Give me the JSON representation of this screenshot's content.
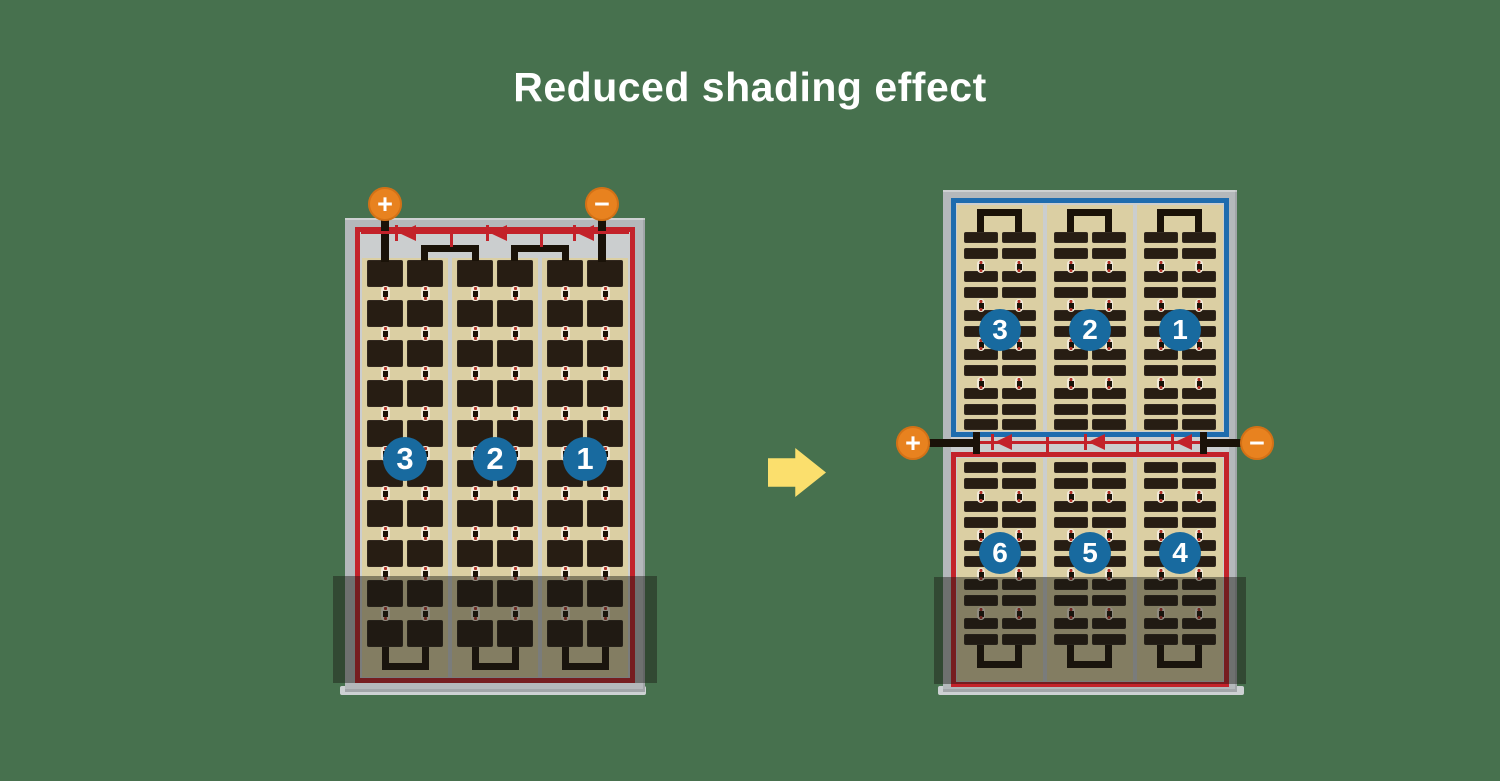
{
  "title": "Reduced shading effect",
  "colors": {
    "bg": "#47714e",
    "title": "#ffffff",
    "frame": "#b4b8bb",
    "silver": "#cbcecf",
    "tan": "#dbcfa3",
    "cell": "#271d13",
    "wire": "#1a1208",
    "red": "#c3222a",
    "blue": "#1e6cae",
    "circle": "#186a9f",
    "orange": "#e8821f",
    "arrow": "#fbdf6d",
    "dotred": "#b23128",
    "shading": "rgba(24,25,21,0.45)"
  },
  "icons": {
    "arrow": "right-arrow",
    "diode": "bypass-diode",
    "plus_terminal": "plus-terminal",
    "minus_terminal": "minus-terminal"
  },
  "left_panel": {
    "strings": [
      {
        "label": "3"
      },
      {
        "label": "2"
      },
      {
        "label": "1"
      }
    ],
    "terminals": {
      "plus": "+",
      "minus": "−"
    },
    "bypass_diodes": 3,
    "cell_columns": 6,
    "cell_rows": 10
  },
  "right_panel": {
    "top_strings": [
      {
        "label": "3"
      },
      {
        "label": "2"
      },
      {
        "label": "1"
      }
    ],
    "bottom_strings": [
      {
        "label": "6"
      },
      {
        "label": "5"
      },
      {
        "label": "4"
      }
    ],
    "terminals": {
      "plus": "+",
      "minus": "−"
    },
    "bypass_diodes": 3,
    "string_subcolumns": 2
  }
}
